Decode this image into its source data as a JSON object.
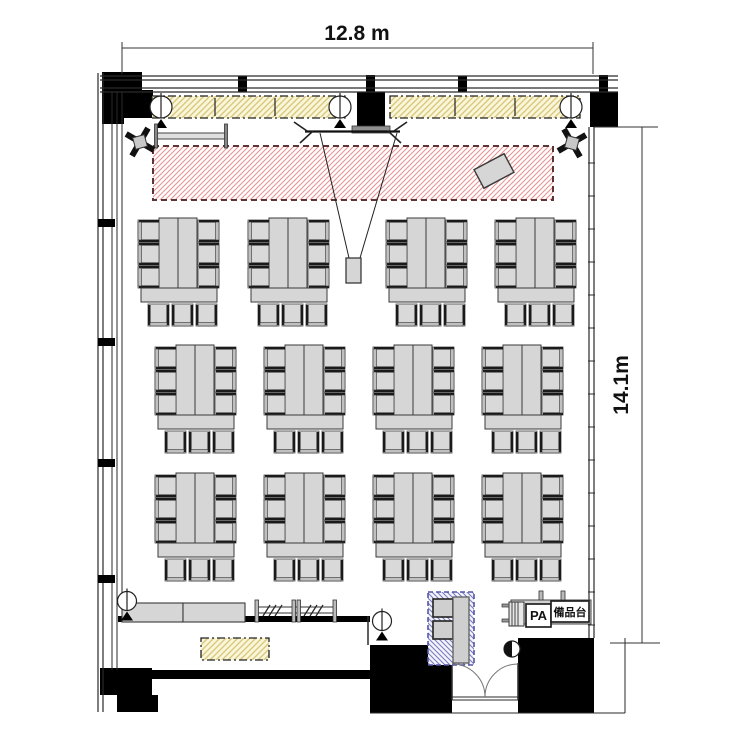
{
  "meta": {
    "title": "banquet-room-floor-plan",
    "canvas": {
      "w": 750,
      "h": 750
    }
  },
  "dimension_labels": {
    "width": "12.8 m",
    "height": "14.1m"
  },
  "text_labels": {
    "pa": "PA",
    "equipment_stand": "備品台"
  },
  "colors": {
    "wall": "#000000",
    "line": "#2a2a2a",
    "furniture_fill": "#d6d6d6",
    "furniture_stroke": "#3a3a3a",
    "chair_fill": "#d9d9d9",
    "batten_fill": "#faf6da",
    "batten_hatch": "#d9c87e",
    "stage_hatch": "#e89494",
    "stage_border": "#5c3434",
    "shaft_hatch": "#7b7bc0",
    "arc": "#777777"
  },
  "plan": {
    "black_rects": [
      [
        102,
        72,
        40,
        46,
        "column-top-left"
      ],
      [
        140,
        90,
        13,
        28,
        "column-top-left-arm"
      ],
      [
        102,
        116,
        22,
        8,
        "column-top-left-step"
      ],
      [
        357,
        92,
        28,
        36,
        "column-top-center"
      ],
      [
        366,
        75,
        9,
        17,
        "column-top-center-cap"
      ],
      [
        590,
        92,
        28,
        35,
        "column-top-right"
      ],
      [
        599,
        75,
        9,
        17,
        "column-top-right-cap"
      ],
      [
        238,
        76,
        9,
        16,
        "window-mullion-top-1"
      ],
      [
        458,
        76,
        9,
        16,
        "window-mullion-top-2"
      ],
      [
        100,
        668,
        52,
        27,
        "column-bottom-left"
      ],
      [
        117,
        695,
        41,
        17,
        "column-bottom-left-step"
      ],
      [
        100,
        670,
        272,
        9,
        "wall-bottom-left-band"
      ],
      [
        370,
        645,
        82,
        68,
        "wall-bottom-center-block"
      ],
      [
        518,
        638,
        76,
        75,
        "wall-bottom-right-block"
      ],
      [
        118,
        616,
        252,
        6,
        "wall-south-left"
      ]
    ],
    "wall_lines": [
      [
        100,
        76,
        618,
        76,
        1.2
      ],
      [
        100,
        80,
        618,
        80,
        1.2
      ],
      [
        100,
        88,
        618,
        88,
        1.2
      ],
      [
        100,
        92,
        618,
        92,
        1.2
      ],
      [
        98,
        73,
        98,
        712,
        1.2
      ],
      [
        103,
        73,
        103,
        712,
        1.2
      ],
      [
        112,
        92,
        112,
        670,
        1
      ],
      [
        117,
        92,
        117,
        670,
        1
      ],
      [
        122,
        92,
        122,
        618,
        1
      ],
      [
        589,
        127,
        589,
        638,
        1.2
      ],
      [
        594,
        127,
        594,
        638,
        1.2
      ],
      [
        594,
        127,
        658,
        127,
        1
      ],
      [
        610,
        643,
        660,
        643,
        1
      ],
      [
        368,
        616,
        368,
        645,
        1.5
      ],
      [
        370,
        713,
        625,
        713,
        1
      ],
      [
        625,
        638,
        625,
        713,
        1
      ],
      [
        452,
        697,
        518,
        697,
        1
      ],
      [
        452,
        700,
        518,
        700,
        1
      ],
      [
        452,
        663,
        452,
        700,
        1.5
      ],
      [
        518,
        663,
        518,
        700,
        1.5
      ]
    ],
    "right_wall_ticks": {
      "x1": 588,
      "x2": 595,
      "y_start": 163,
      "step": 33,
      "count": 15
    },
    "window_marks": [
      [
        98,
        219,
        17,
        8
      ],
      [
        98,
        338,
        17,
        8
      ],
      [
        98,
        459,
        17,
        8
      ],
      [
        98,
        575,
        17,
        8
      ]
    ],
    "battens": {
      "y": 96,
      "h": 22,
      "segments": [
        [
          152,
          345
        ],
        [
          390,
          580
        ]
      ],
      "dividers": [
        215,
        275,
        455,
        515
      ],
      "lights": [
        [
          161,
          107
        ],
        [
          340,
          107
        ],
        [
          571,
          107
        ]
      ]
    },
    "stage": [
      153,
      146,
      400,
      54
    ],
    "podium": {
      "cx": 494,
      "cy": 171,
      "w": 34,
      "h": 21,
      "angle": -28
    },
    "head_rail": {
      "x1": 156,
      "x2": 226,
      "post_y": 124,
      "post_h": 24,
      "rail_y": 133,
      "rail_h": 6
    },
    "screen": {
      "bar": [
        352,
        126,
        38,
        7
      ],
      "line": [
        305,
        131.5,
        400,
        131.5
      ],
      "legs": [
        [
          307,
          131,
          294,
          122
        ],
        [
          313,
          131,
          300,
          143
        ],
        [
          394,
          131,
          407,
          122
        ],
        [
          388,
          131,
          401,
          143
        ]
      ]
    },
    "projector": {
      "box": [
        346,
        258,
        15,
        25
      ],
      "cone": [
        [
          320,
          133,
          349,
          258
        ],
        [
          397,
          133,
          360,
          258
        ]
      ]
    },
    "speakers": [
      {
        "cx": 140,
        "cy": 142,
        "a": 30
      },
      {
        "cx": 572,
        "cy": 143,
        "a": -30
      }
    ],
    "islands": {
      "rows": [
        {
          "top": 218,
          "lefts": [
            138,
            248,
            386,
            495
          ]
        },
        {
          "top": 345,
          "lefts": [
            155,
            264,
            373,
            482
          ]
        },
        {
          "top": 473,
          "lefts": [
            155,
            264,
            373,
            482
          ]
        }
      ],
      "side_chair_ys": [
        2,
        25,
        48
      ],
      "bottom_chair_xs": [
        10,
        34,
        58
      ]
    },
    "counter": {
      "rects": [
        [
          122,
          603,
          61,
          19
        ],
        [
          183,
          603,
          62,
          19
        ]
      ]
    },
    "storage_rack": {
      "posts": [
        255,
        292,
        297,
        333
      ],
      "post_y": 600,
      "post_h": 22,
      "rail_ys": [
        607,
        613
      ],
      "x1": 255,
      "x2": 335,
      "hatch_cx": [
        272,
        313
      ]
    },
    "alcove_mat": [
      201,
      638,
      68,
      22
    ],
    "shaft": {
      "outer": [
        428,
        592,
        46,
        73
      ],
      "squares": [
        [
          433,
          599,
          20,
          18
        ],
        [
          433,
          621,
          20,
          18
        ]
      ],
      "panel": [
        453,
        597,
        16,
        66
      ]
    },
    "door": {
      "arc1": "M452,664 A33,33 0 0 1 485,697",
      "arc2": "M518,664 A33,33 0 0 0 485,697",
      "half_circle": {
        "cx": 512,
        "cy": 649,
        "r": 8
      }
    },
    "pa_area": {
      "shelf": [
        511,
        600,
        80,
        24
      ],
      "posts": [
        [
          539,
          591,
          4,
          9
        ],
        [
          561,
          591,
          4,
          9
        ]
      ],
      "ladder": {
        "outer": [
          509,
          602,
          15,
          24
        ],
        "vlines": [
          512,
          515,
          518
        ],
        "stubs": [
          [
            502,
            604,
            7,
            3
          ],
          [
            502,
            619,
            7,
            3
          ]
        ]
      },
      "pa_box": [
        526,
        604,
        25,
        23
      ],
      "eq_box": [
        551,
        601,
        38,
        21
      ]
    },
    "floor_lights": [
      [
        127,
        601
      ],
      [
        382,
        621
      ]
    ],
    "dim_h": {
      "line": [
        122,
        48,
        593,
        48
      ],
      "ticks": [
        [
          122,
          42,
          122,
          74
        ],
        [
          593,
          42,
          593,
          74
        ]
      ]
    },
    "dim_v": {
      "line": [
        642,
        127,
        642,
        643
      ],
      "ticks": [
        [
          594,
          127,
          658,
          127
        ],
        [
          610,
          643,
          660,
          643
        ]
      ]
    }
  }
}
